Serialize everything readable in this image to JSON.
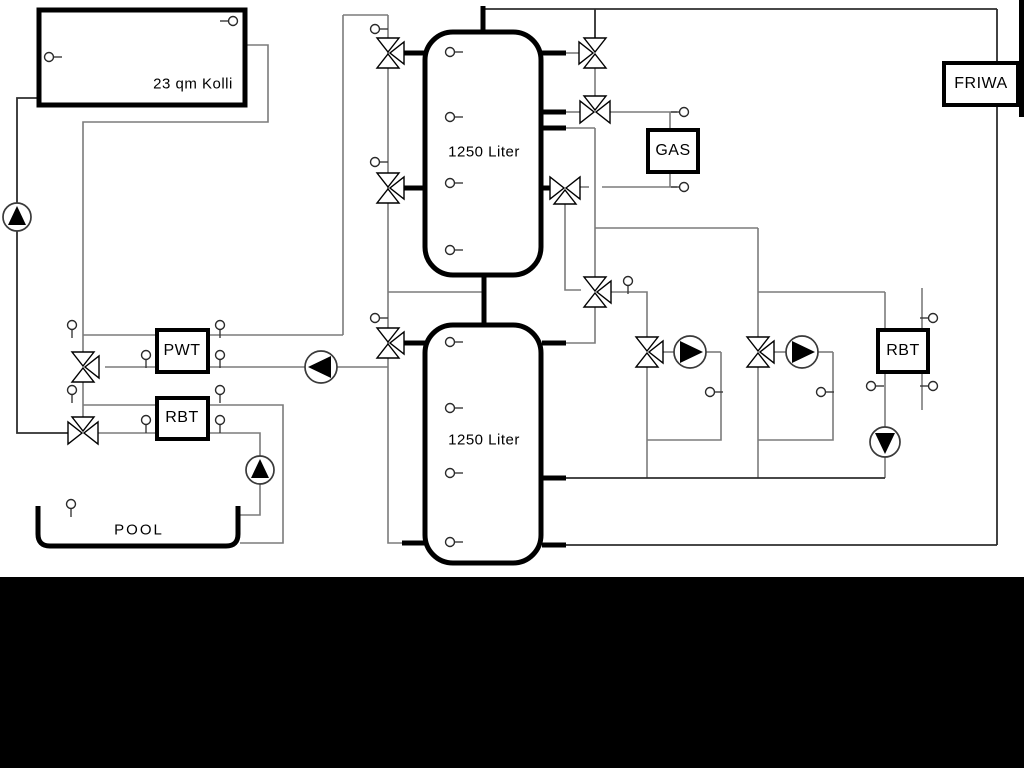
{
  "title": "Hydraulic scheme - solar buffer tanks with gas boiler, FRIWA and pool",
  "labels": {
    "collector": "23 qm Kolli",
    "tank_upper": "1250 Liter",
    "tank_lower": "1250 Liter",
    "pwt": "PWT",
    "rbt_left": "RBT",
    "gas": "GAS",
    "friwa": "FRIWA",
    "rbt_right": "RBT",
    "pool": "POOL"
  },
  "icons": {
    "pump": "circle with solid triangle showing flow direction",
    "three_way_valve": "double-triangle bowtie with third branch triangle",
    "sensor": "small circle probe with stem"
  },
  "colors": {
    "background": "#ffffff",
    "pipe_gray": "#7b7b7b",
    "pipe_dark": "#2e2e2e",
    "component_black": "#000000",
    "letterbox": "#000000"
  }
}
